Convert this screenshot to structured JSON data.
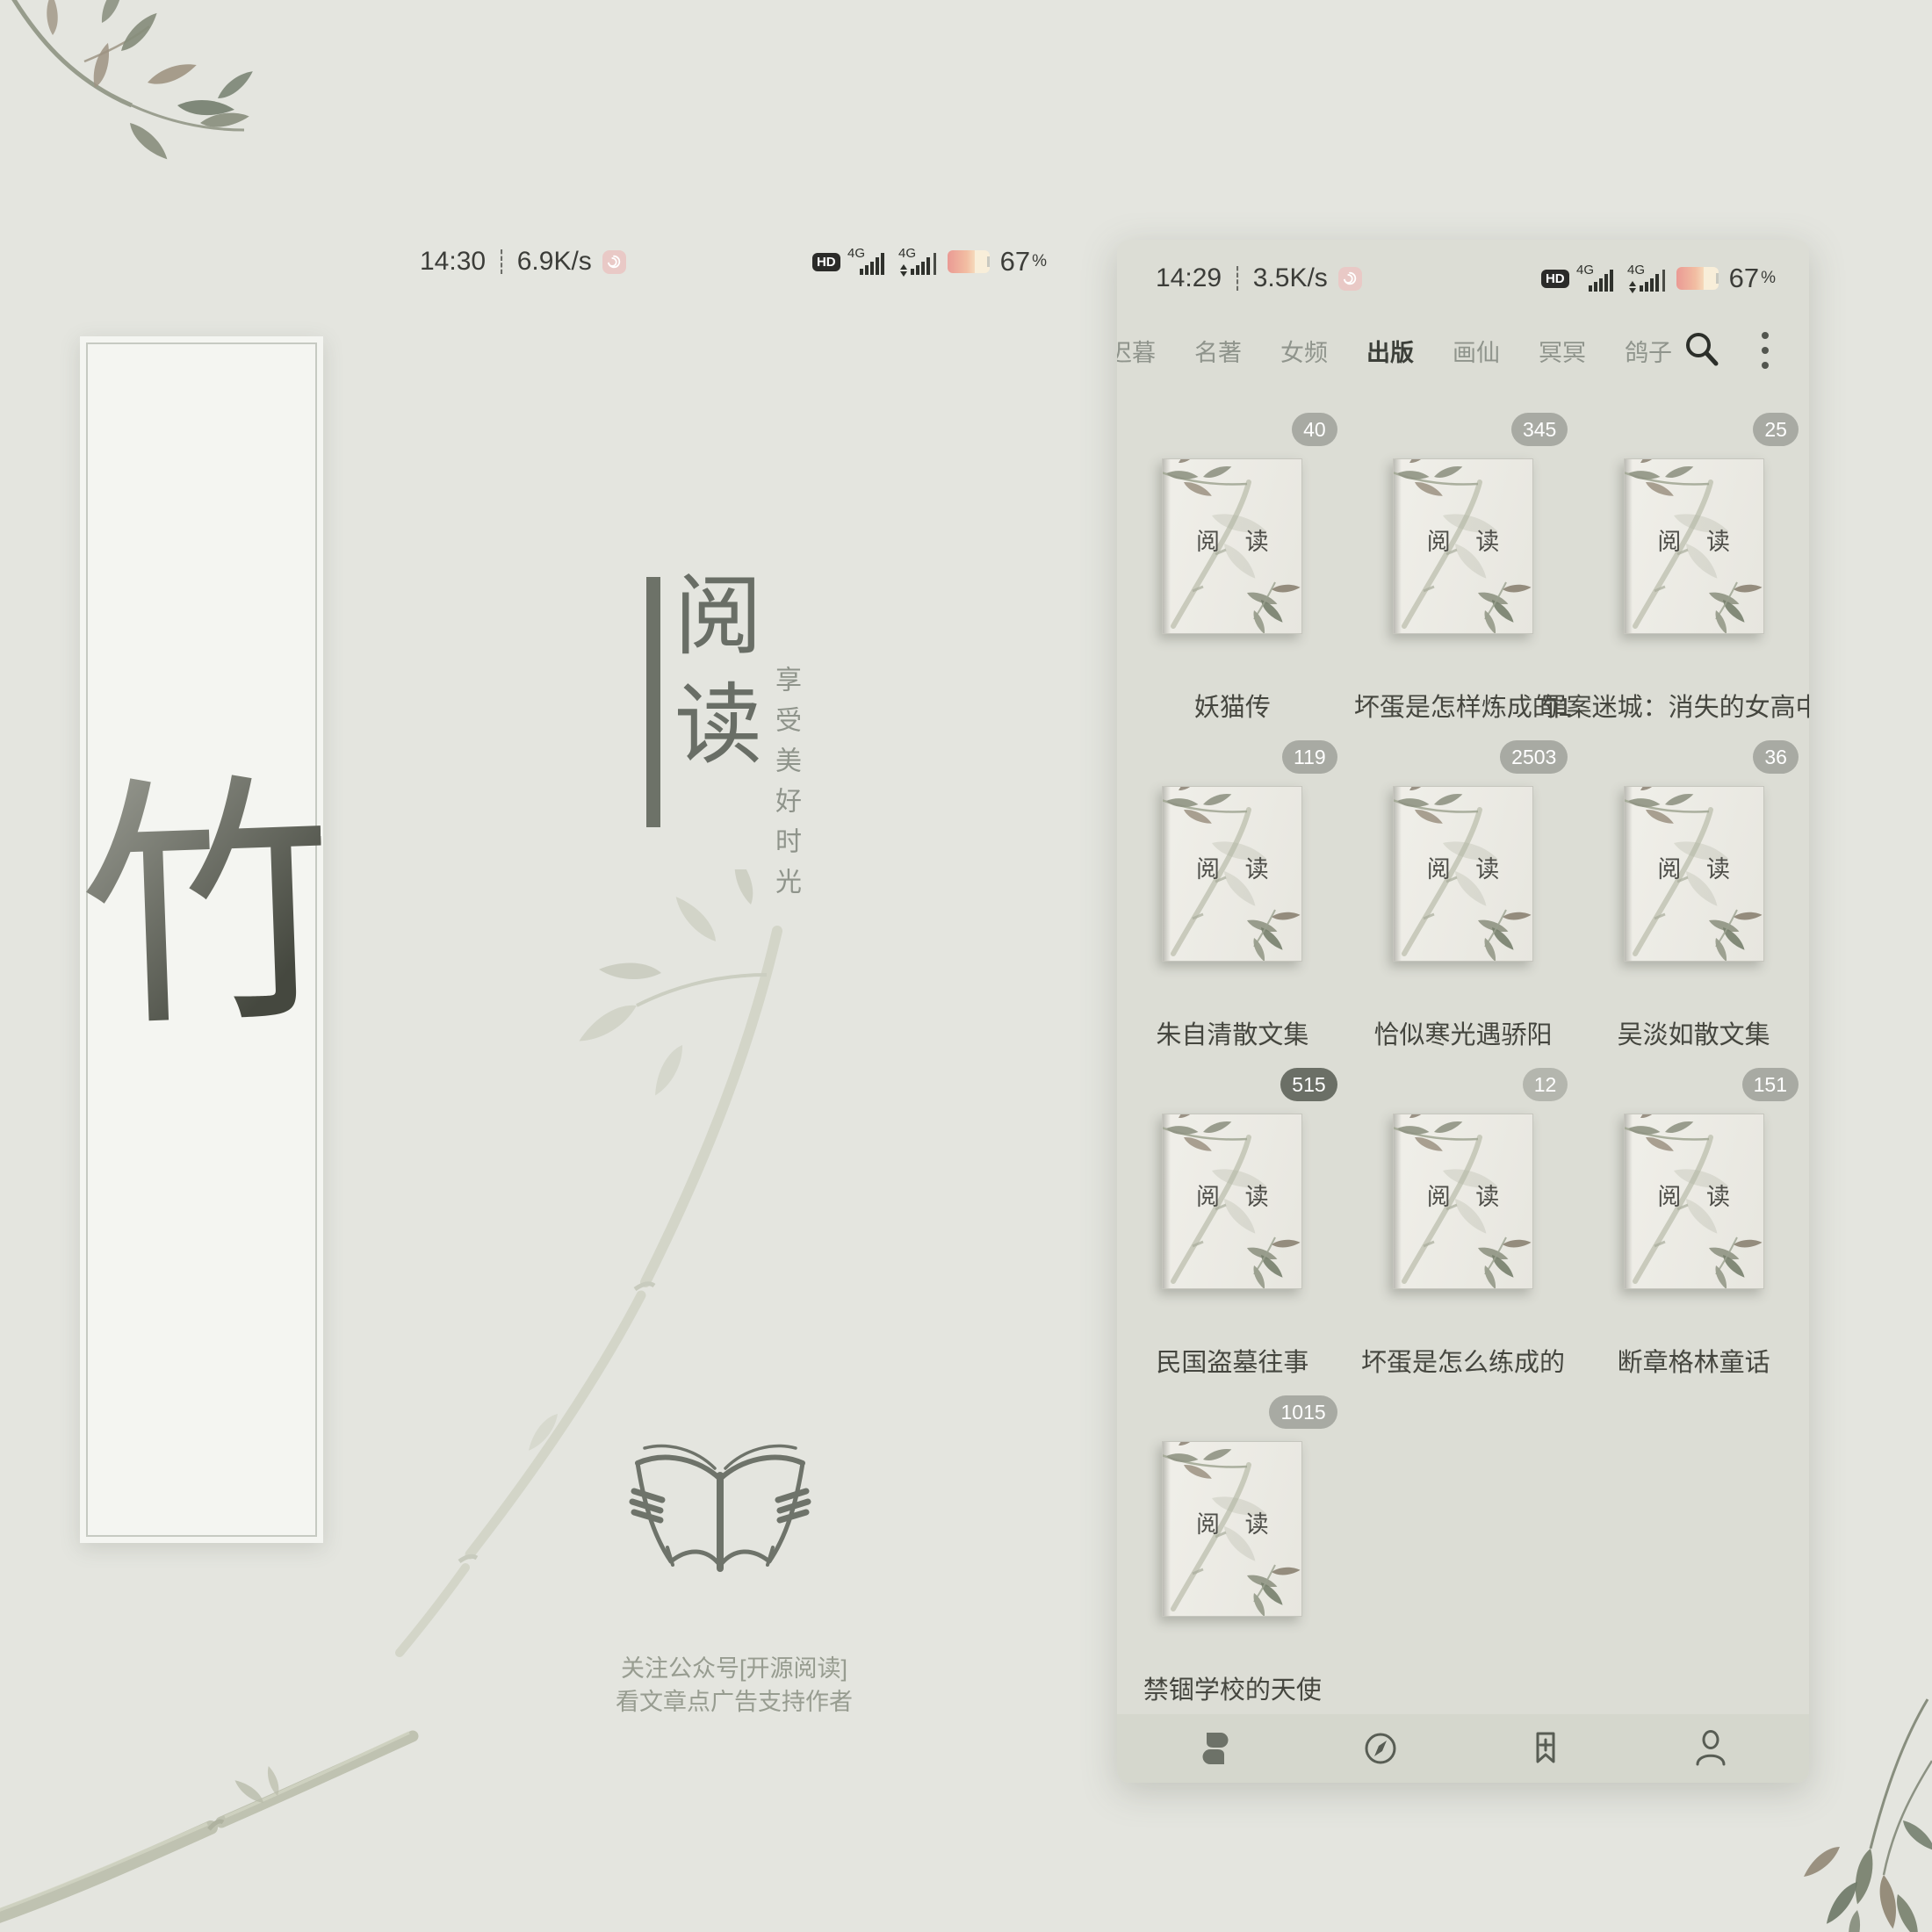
{
  "colors": {
    "background": "#e4e5df",
    "panel": "#dcddd5",
    "nav_bar": "#d5d7cd",
    "badge_default": "#a8aaa3",
    "accent_text": "#3c3f39",
    "battery_gradient_start": "#ea9a94",
    "battery_gradient_end": "#f5d9bb",
    "notification_icon_pink": "#e9c9c6"
  },
  "wallpaper": {
    "status": {
      "time": "14:30",
      "sep": "┊",
      "speed": "6.9K/s",
      "hd": "HD",
      "net1": "4G",
      "net2": "4G",
      "battery": "67",
      "percent": "%"
    },
    "scroll_char": "竹",
    "app_title_top": "阅",
    "app_title_bottom": "读",
    "slogan": "享受美好时光",
    "footer_line1": "关注公众号[开源阅读]",
    "footer_line2": "看文章点广告支持作者"
  },
  "phone": {
    "status": {
      "time": "14:29",
      "sep": "┊",
      "speed": "3.5K/s",
      "hd": "HD",
      "net1": "4G",
      "net2": "4G",
      "battery": "67",
      "percent": "%"
    },
    "tabs": [
      {
        "label": "迟暮"
      },
      {
        "label": "名著"
      },
      {
        "label": "女频"
      },
      {
        "label": "出版",
        "active": true
      },
      {
        "label": "画仙"
      },
      {
        "label": "冥冥"
      },
      {
        "label": "鸽子"
      }
    ],
    "toolbar_icons": {
      "search": "search-icon",
      "more": "kebab-menu-icon"
    },
    "cover_text": "阅 读",
    "books": [
      {
        "title": "妖猫传",
        "badge": "40"
      },
      {
        "title": "坏蛋是怎样炼成的1",
        "badge": "345"
      },
      {
        "title": "罪案迷城：消失的女高中生",
        "badge": "25"
      },
      {
        "title": "朱自清散文集",
        "badge": "119"
      },
      {
        "title": "恰似寒光遇骄阳",
        "badge": "2503"
      },
      {
        "title": "吴淡如散文集",
        "badge": "36"
      },
      {
        "title": "民国盗墓往事",
        "badge": "515",
        "badge_style": "background:#6b6f66"
      },
      {
        "title": "坏蛋是怎么练成的",
        "badge": "12",
        "badge_style": "background:#b4b6ae"
      },
      {
        "title": "断章格林童话",
        "badge": "151"
      },
      {
        "title": "禁锢学校的天使",
        "badge": "1015"
      }
    ],
    "nav_icons": [
      "bookshelf-icon",
      "compass-icon",
      "bookmark-add-icon",
      "person-icon"
    ]
  }
}
